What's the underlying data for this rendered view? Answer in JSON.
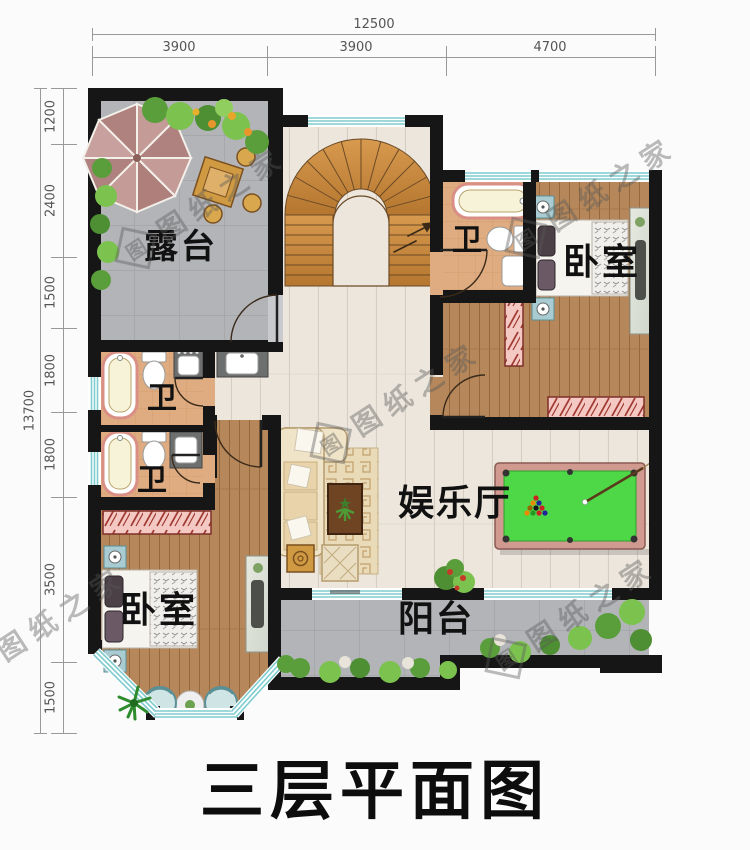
{
  "title": "三层平面图",
  "watermark": {
    "text": "图纸之家",
    "logo_char": "图"
  },
  "dimensions": {
    "top": {
      "total": "12500",
      "segments": [
        "3900",
        "3900",
        "4700"
      ]
    },
    "left": {
      "total": "13700",
      "segments": [
        "1200",
        "2400",
        "1500",
        "1800",
        "1800",
        "3500",
        "1500"
      ]
    }
  },
  "rooms": {
    "terrace": "露台",
    "bath_top": "卫",
    "bedroom_top": "卧室",
    "bath_mid": "卫",
    "bath_low": "卫",
    "bedroom_bottom": "卧室",
    "hall": "娱乐厅",
    "balcony": "阳台"
  },
  "colors": {
    "wall": "#161616",
    "window_teal": "#7ecccf",
    "hall_wood": "#ece6dd",
    "bedroom_wood": "#b5875a",
    "terrace_tile": "#b2b4b8",
    "bath_floor": "#deac80",
    "stair_wood": "#c98c45",
    "pool_felt": "#4ed848",
    "pool_rail": "#d09a90",
    "dresser_pink": "#f4c9c3"
  }
}
